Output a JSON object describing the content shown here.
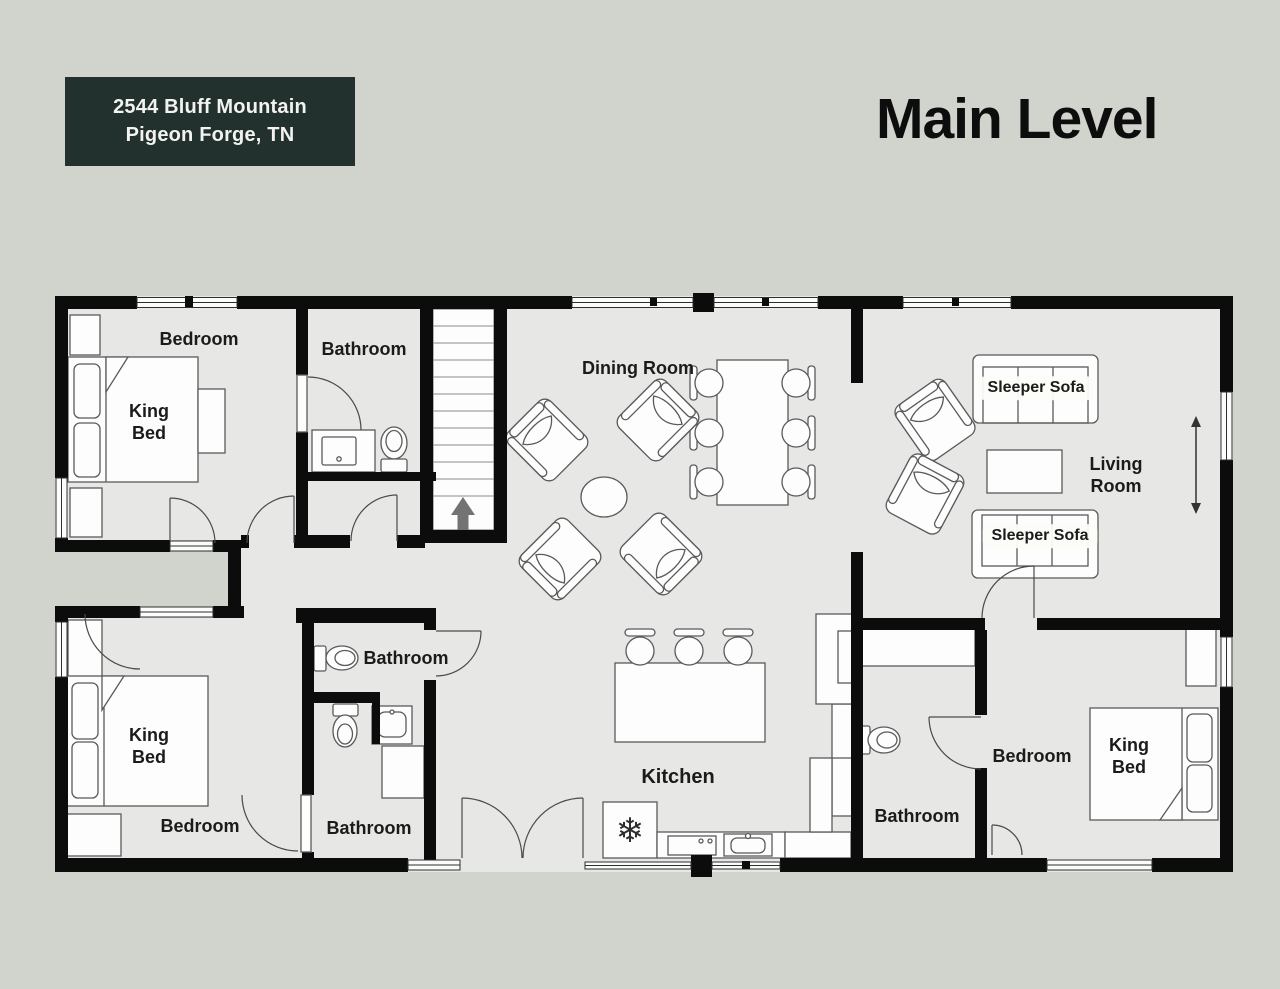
{
  "header": {
    "address_line1": "2544 Bluff Mountain",
    "address_line2": "Pigeon Forge, TN",
    "title": "Main Level"
  },
  "colors": {
    "page_background": "#d1d4cd",
    "floor": "#e7e8e5",
    "wall": "#0c0c0c",
    "address_box_background": "#22302e",
    "address_box_text": "#f2f3f0",
    "furniture_fill": "#fdfdfd",
    "furniture_stroke": "#5a5a5a",
    "label_text": "#1b1b1b"
  },
  "labels": {
    "bedroom_top_left": "Bedroom",
    "bathroom_top_left": "Bathroom",
    "dining_room": "Dining Room",
    "sleeper_sofa_top": "Sleeper Sofa",
    "living_room": "Living Room",
    "sleeper_sofa_bottom": "Sleeper Sofa",
    "king_bed_top_left": "King Bed",
    "king_bed_bottom_left": "King Bed",
    "king_bed_bottom_right": "King Bed",
    "bathroom_mid_upper": "Bathroom",
    "bathroom_mid_lower": "Bathroom",
    "bedroom_bottom_left": "Bedroom",
    "kitchen": "Kitchen",
    "bathroom_bottom_right": "Bathroom",
    "bedroom_bottom_right": "Bedroom"
  },
  "icons": {
    "fridge_snowflake": "❄"
  }
}
